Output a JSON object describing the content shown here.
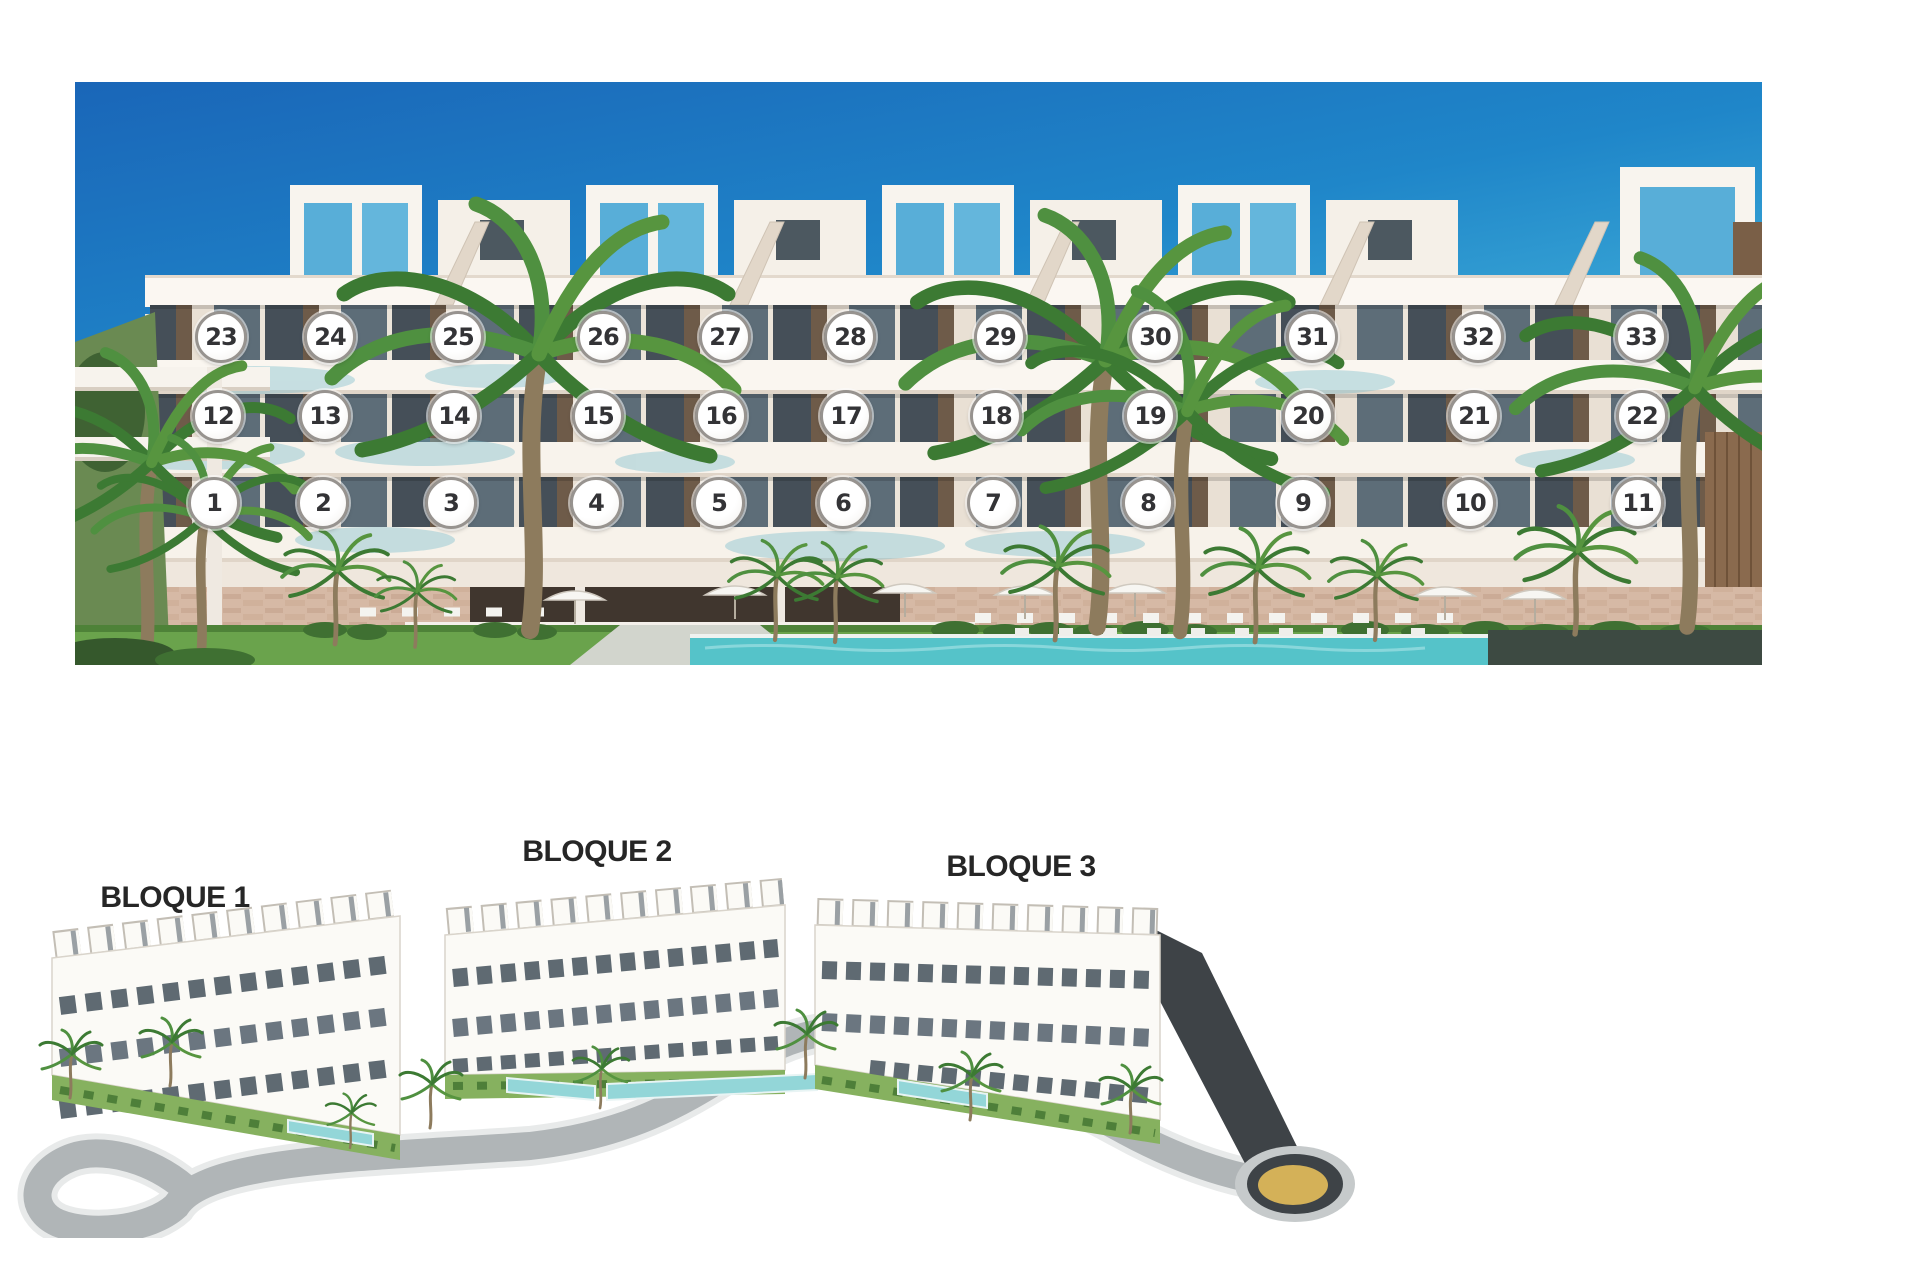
{
  "building_photo": {
    "description": "Front render of apartment building with numbered units",
    "floors": [
      {
        "name": "second-floor",
        "units": [
          {
            "n": "23",
            "x": 221,
            "y": 337
          },
          {
            "n": "24",
            "x": 330,
            "y": 337
          },
          {
            "n": "25",
            "x": 458,
            "y": 337
          },
          {
            "n": "26",
            "x": 603,
            "y": 337
          },
          {
            "n": "27",
            "x": 725,
            "y": 337
          },
          {
            "n": "28",
            "x": 850,
            "y": 337
          },
          {
            "n": "29",
            "x": 1000,
            "y": 337
          },
          {
            "n": "30",
            "x": 1155,
            "y": 337
          },
          {
            "n": "31",
            "x": 1312,
            "y": 337
          },
          {
            "n": "32",
            "x": 1478,
            "y": 337
          },
          {
            "n": "33",
            "x": 1641,
            "y": 337
          }
        ]
      },
      {
        "name": "first-floor",
        "units": [
          {
            "n": "12",
            "x": 218,
            "y": 416
          },
          {
            "n": "13",
            "x": 325,
            "y": 416
          },
          {
            "n": "14",
            "x": 454,
            "y": 416
          },
          {
            "n": "15",
            "x": 598,
            "y": 416
          },
          {
            "n": "16",
            "x": 721,
            "y": 416
          },
          {
            "n": "17",
            "x": 846,
            "y": 416
          },
          {
            "n": "18",
            "x": 996,
            "y": 416
          },
          {
            "n": "19",
            "x": 1150,
            "y": 416
          },
          {
            "n": "20",
            "x": 1308,
            "y": 416
          },
          {
            "n": "21",
            "x": 1474,
            "y": 416
          },
          {
            "n": "22",
            "x": 1642,
            "y": 416
          }
        ]
      },
      {
        "name": "ground-floor",
        "units": [
          {
            "n": "1",
            "x": 214,
            "y": 503
          },
          {
            "n": "2",
            "x": 323,
            "y": 503
          },
          {
            "n": "3",
            "x": 451,
            "y": 503
          },
          {
            "n": "4",
            "x": 596,
            "y": 503
          },
          {
            "n": "5",
            "x": 719,
            "y": 503
          },
          {
            "n": "6",
            "x": 843,
            "y": 503
          },
          {
            "n": "7",
            "x": 993,
            "y": 503
          },
          {
            "n": "8",
            "x": 1148,
            "y": 503
          },
          {
            "n": "9",
            "x": 1303,
            "y": 503
          },
          {
            "n": "10",
            "x": 1470,
            "y": 503
          },
          {
            "n": "11",
            "x": 1638,
            "y": 503
          }
        ]
      }
    ]
  },
  "site_plan": {
    "blocks": [
      {
        "label": "BLOQUE 1",
        "x": 175,
        "y": 898
      },
      {
        "label": "BLOQUE 2",
        "x": 597,
        "y": 852
      },
      {
        "label": "BLOQUE 3",
        "x": 1021,
        "y": 867
      }
    ]
  },
  "colors": {
    "sky_top": "#1d6fbe",
    "sky_light": "#bfe6ee",
    "facade": "#f3ebe2",
    "stone_base": "#d6b9a5",
    "grass": "#6aa34c",
    "pool": "#55c3c9",
    "dark_band": "#3d4a42",
    "marker_border": "#97938f",
    "marker_text": "#333336",
    "label_text": "#262626",
    "road": "#b0b5b7",
    "roundabout_ring": "#3e4347",
    "roundabout_center": "#d4b158"
  }
}
